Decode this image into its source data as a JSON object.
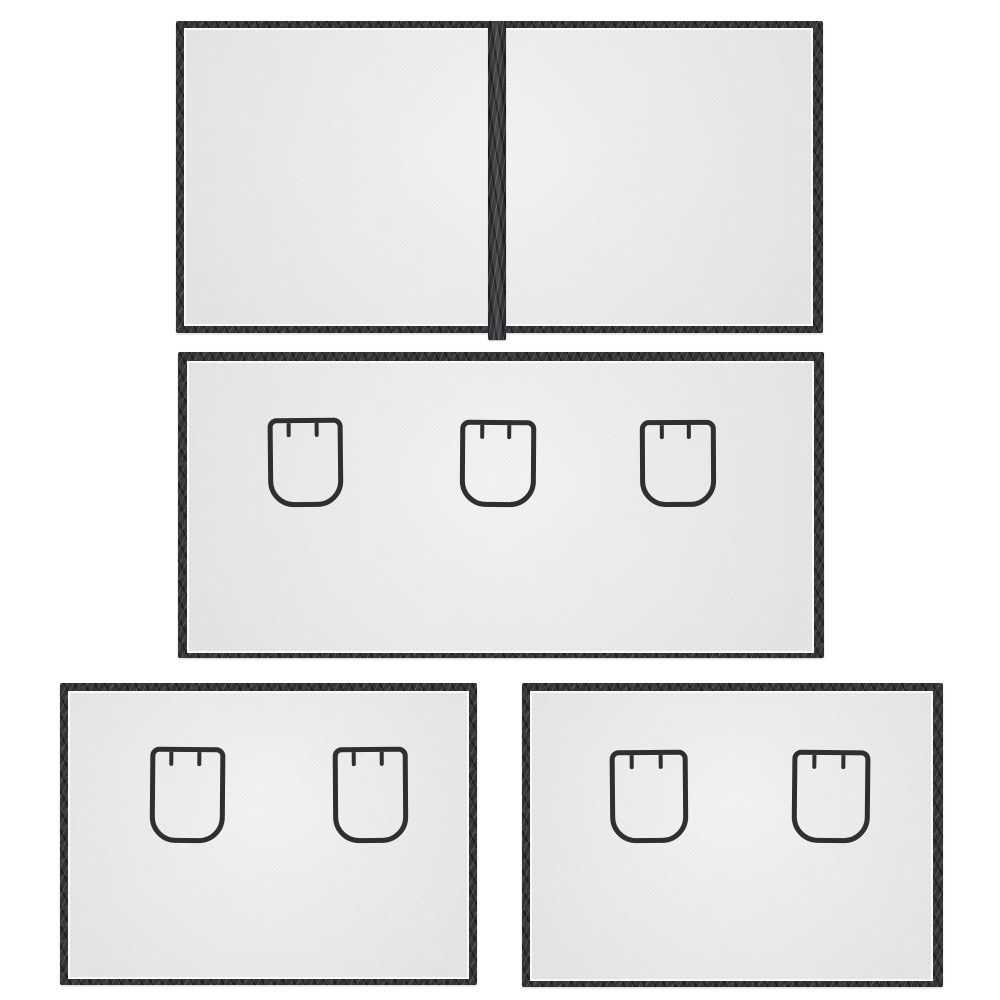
{
  "scene": {
    "description": "Product photo of four magnetic mesh screen panels with dark vinyl trim on a white background",
    "background_color": "#ffffff",
    "colors": {
      "mesh": "#e9eaea",
      "trim": "#323436",
      "trim_highlight": "#55585b",
      "flap_outline": "#2d2f30",
      "inner_seam": "#fafafa"
    },
    "flap_style": {
      "stroke_px": 5,
      "tick_width_px": 4,
      "tick_height_px": 14,
      "tick_positions_pct": [
        22,
        64
      ]
    },
    "panels": [
      {
        "name": "top-double-panel-with-center-zipper",
        "x": 176,
        "y": 21,
        "width": 647,
        "height": 312,
        "trim": "7px 10px 7px 8px",
        "zipper": {
          "x": 312,
          "width": 18,
          "tail": 7
        },
        "flaps": []
      },
      {
        "name": "middle-wide-panel-three-flaps",
        "x": 178,
        "y": 352,
        "width": 646,
        "height": 306,
        "trim": "9px 10px 5px 9px",
        "flaps": [
          {
            "x": 90,
            "y": 66,
            "width": 75,
            "height": 89,
            "tilt": -0.6
          },
          {
            "x": 282,
            "y": 68,
            "width": 76,
            "height": 87,
            "tilt": 0.4
          },
          {
            "x": 462,
            "y": 68,
            "width": 76,
            "height": 87,
            "tilt": -0.3
          }
        ]
      },
      {
        "name": "bottom-left-panel-two-flaps",
        "x": 60,
        "y": 683,
        "width": 417,
        "height": 302,
        "trim": "8px 8px 6px 8px",
        "flaps": [
          {
            "x": 90,
            "y": 64,
            "width": 75,
            "height": 96,
            "tilt": 0.5
          },
          {
            "x": 273,
            "y": 64,
            "width": 75,
            "height": 96,
            "tilt": -0.4
          }
        ]
      },
      {
        "name": "bottom-right-panel-two-flaps",
        "x": 522,
        "y": 683,
        "width": 421,
        "height": 304,
        "trim": "8px 10px 6px 8px",
        "flaps": [
          {
            "x": 88,
            "y": 67,
            "width": 78,
            "height": 93,
            "tilt": -0.5
          },
          {
            "x": 270,
            "y": 67,
            "width": 78,
            "height": 93,
            "tilt": 0.6
          }
        ]
      }
    ]
  }
}
